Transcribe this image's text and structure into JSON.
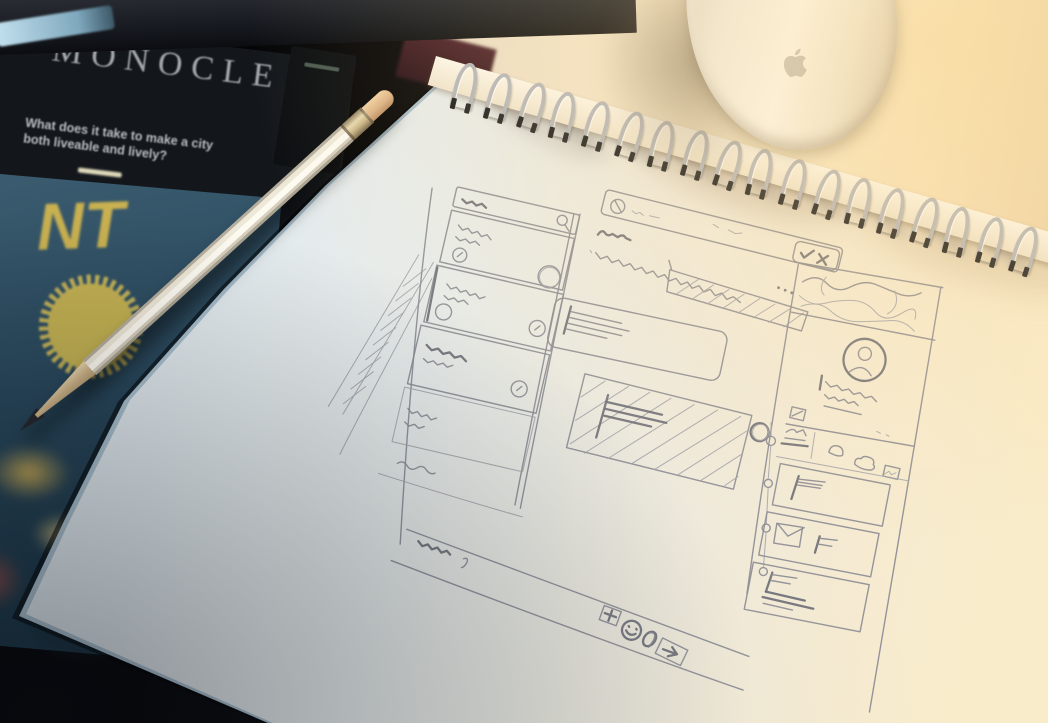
{
  "scene": {
    "description": "photo of a desk: spiral sketchbook with hand-drawn pencil website wireframe, white pencil, Apple mouse, magazines in shadow",
    "palette": {
      "desk_shadow": "#0a0a0c",
      "desk_warm": "#f4e3c2",
      "paper_cool": "#dfe9ee",
      "paper_warm": "#f8e9c9",
      "pencil_stroke": "#8a8a92",
      "accent_yellow": "#d3b54e",
      "cover_teal": "#2c4b5e"
    }
  },
  "magazine": {
    "masthead": "MONOCLE",
    "headline": "What does it take to make a city both liveable and lively?",
    "cover_letter_fragments": [
      "NT",
      "AS",
      "ERS",
      "S"
    ],
    "badge": "yellow sunburst seal"
  },
  "notebook": {
    "type": "spiral sketchbook",
    "spiral": {
      "coil_count": 18,
      "wire_color": "#b3b6bd",
      "clip_color": "#17181c"
    }
  },
  "wireframe_sketch": {
    "medium": "pencil on paper",
    "top_bar_icons": [
      "clock-icon",
      "check-icon",
      "x-icon"
    ],
    "sidebar": {
      "search": "magnifier-icon",
      "card_count": 4,
      "badge_circles": 5
    },
    "main": [
      "squiggle heading",
      "hatched banner",
      "overflow dots",
      "avatar circle",
      "rounded hero card with text lines",
      "hatched content box with flag",
      "bold circle marker",
      "timeline with nodes"
    ],
    "right_rail": [
      "wavy map thumbnail",
      "profile avatar",
      "note-icon",
      "upload-icon",
      "camera-icon",
      "image-icon",
      "flag card",
      "envelope + flag card",
      "flag + text card"
    ],
    "composer_icons": [
      "plus-icon",
      "smiley-icon",
      "paperclip-icon",
      "send-arrow-icon"
    ],
    "footer": "squiggle caption"
  },
  "mouse": {
    "brand": "apple-logo",
    "body_color": "#f2efe8"
  },
  "pencil": {
    "body_color": "#f1ece0",
    "eraser_color": "#dfbd96"
  }
}
